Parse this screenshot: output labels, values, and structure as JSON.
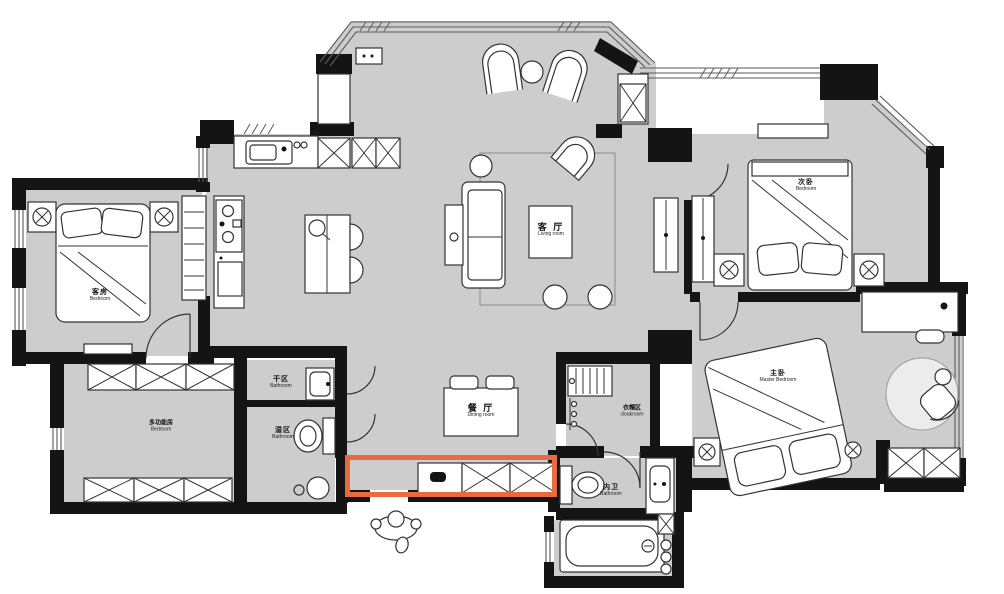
{
  "palette": {
    "floor": "#cdcdcd",
    "wall": "#141414",
    "furniture_line": "#333333",
    "highlight": "#e96a3e"
  },
  "rooms": [
    {
      "id": "living-room",
      "zh": "客 厅",
      "en": "Living room"
    },
    {
      "id": "dining-room",
      "zh": "餐 厅",
      "en": "Dining room"
    },
    {
      "id": "guest-bedroom",
      "zh": "客房",
      "en": "Bedroom"
    },
    {
      "id": "multifunction-room",
      "zh": "多功能房",
      "en": "Bedroom"
    },
    {
      "id": "dry-area",
      "zh": "干区",
      "en": "Bathroom"
    },
    {
      "id": "wet-area",
      "zh": "湿区",
      "en": "Bathroom"
    },
    {
      "id": "cloakroom",
      "zh": "衣帽区",
      "en": "cloakroom"
    },
    {
      "id": "master-bedroom",
      "zh": "主卧",
      "en": "Master Bedroom"
    },
    {
      "id": "secondary-bedroom",
      "zh": "次卧",
      "en": "Bedroom"
    },
    {
      "id": "inner-bathroom",
      "zh": "内卫",
      "en": "Bathroom"
    }
  ]
}
